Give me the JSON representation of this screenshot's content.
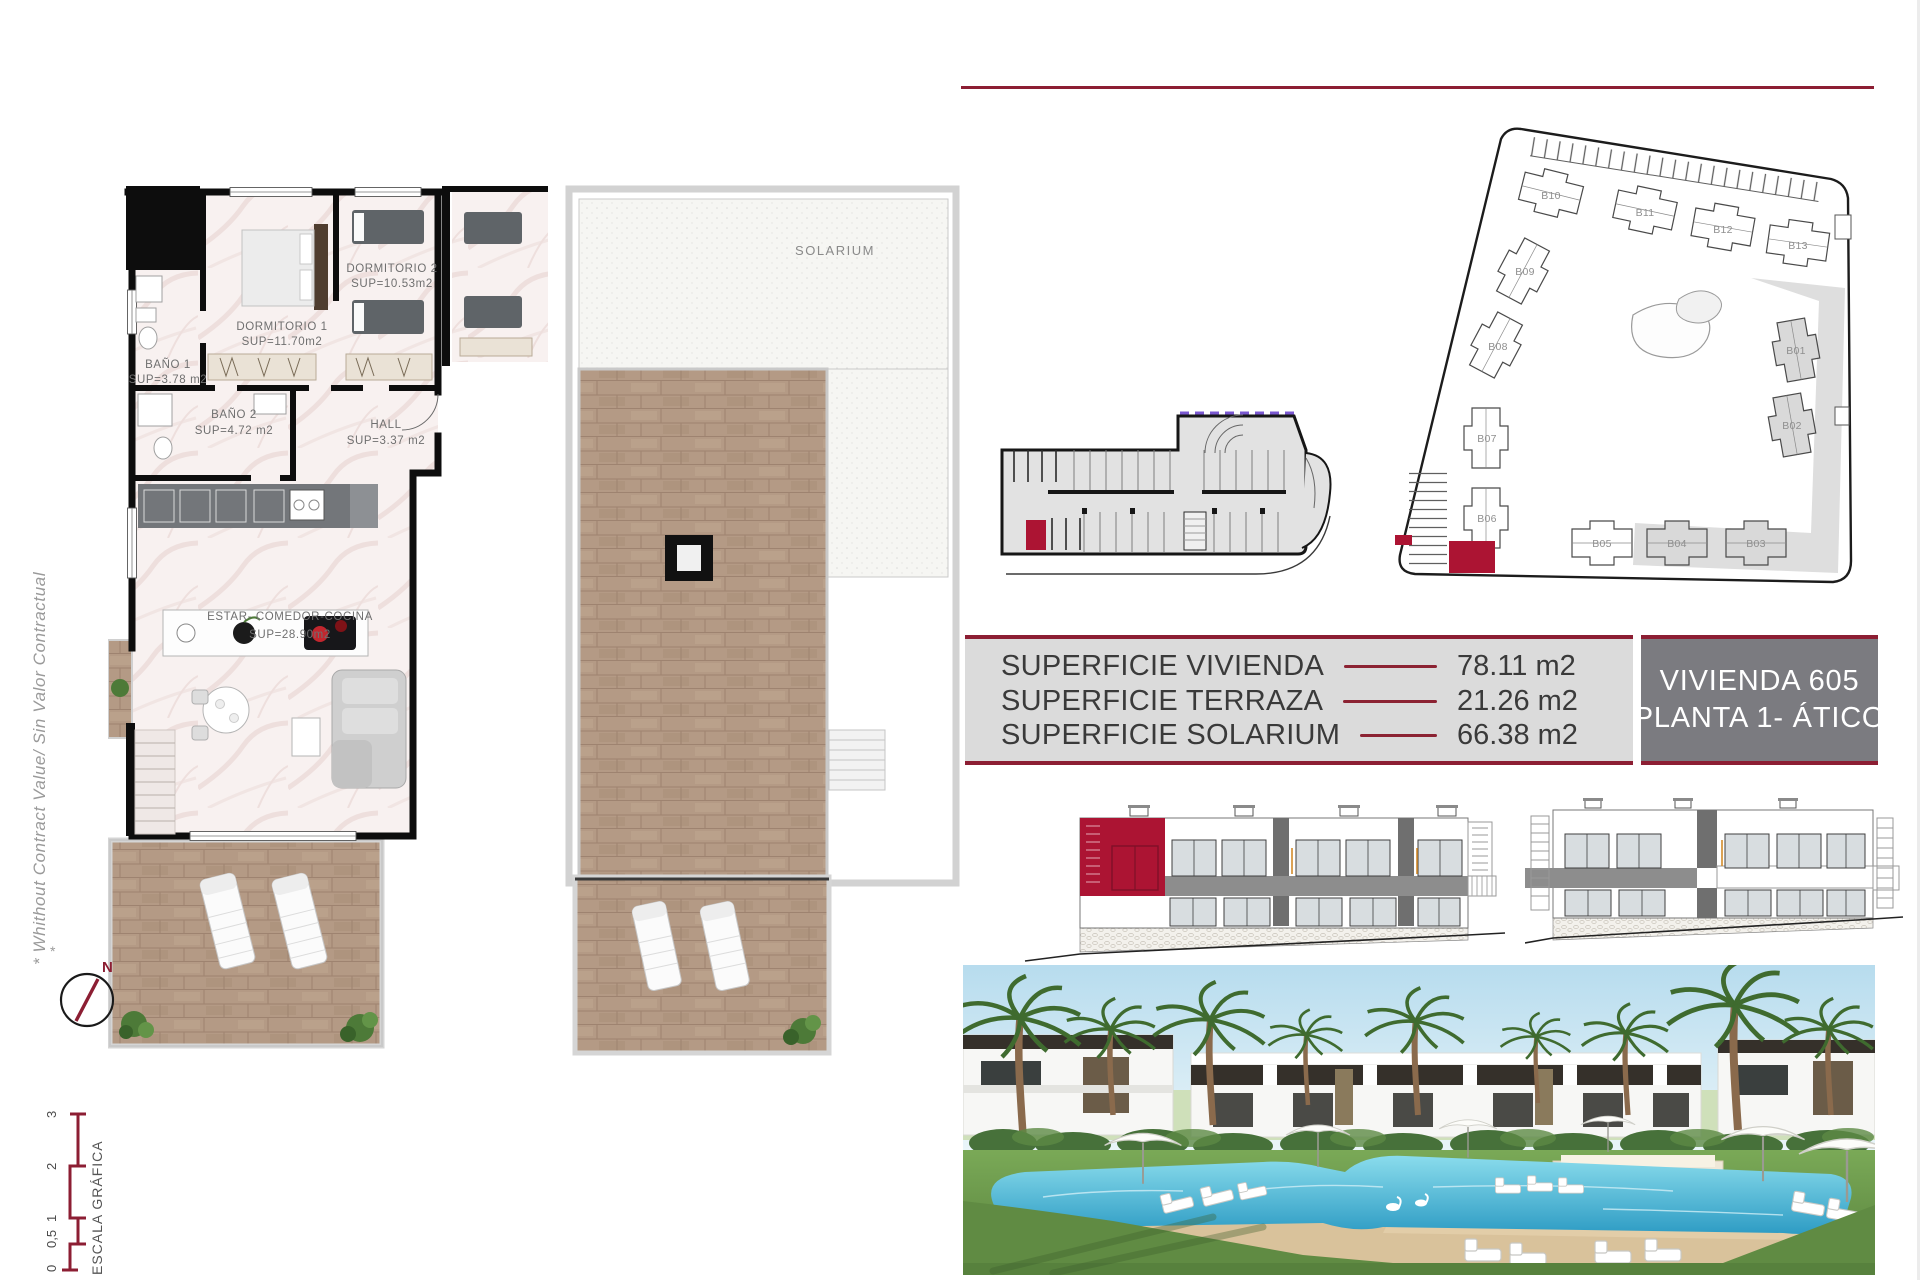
{
  "sheet": {
    "disclaimer": "* Whithout Contract Value/ Sin Valor Contractual",
    "north_label": "N",
    "footnote_star": "*",
    "scale": {
      "label": "ESCALA GRÁFICA",
      "ticks": [
        "0",
        "0,5",
        "1",
        "2",
        "3"
      ]
    }
  },
  "apartment_plan": {
    "rooms": [
      {
        "name": "DORMITORIO 1",
        "sup": "SUP=11.70m2"
      },
      {
        "name": "DORMITORIO 2",
        "sup": "SUP=10.53m2"
      },
      {
        "name": "BAÑO 1",
        "sup": "SUP=3.78 m2"
      },
      {
        "name": "BAÑO 2",
        "sup": "SUP=4.72 m2"
      },
      {
        "name": "HALL",
        "sup": "SUP=3.37 m2"
      },
      {
        "name": "ESTAR- COMEDOR-COCINA",
        "sup": "SUP=28.90m2"
      }
    ]
  },
  "solarium_plan": {
    "label": "SOLARIUM"
  },
  "location_plans": {
    "blocks": [
      "B01",
      "B02",
      "B03",
      "B04",
      "B05",
      "B06",
      "B07",
      "B08",
      "B09",
      "B10",
      "B11",
      "B12",
      "B13"
    ]
  },
  "summary_table": {
    "rows": [
      {
        "label": "SUPERFICIE VIVIENDA",
        "value": "78.11 m2"
      },
      {
        "label": "SUPERFICIE TERRAZA",
        "value": "21.26 m2"
      },
      {
        "label": "SUPERFICIE SOLARIUM",
        "value": "66.38 m2"
      }
    ]
  },
  "unit_badge": {
    "line1": "VIVIENDA 605",
    "line2": "PLANTA 1- ÁTICO"
  },
  "colors": {
    "accent_maroon": "#8c1e33",
    "highlight_red": "#ac1433",
    "table_bg": "#dbdbdb",
    "badge_bg": "#7b7b80",
    "wood": "#b49a85",
    "purple_dash": "#7a58d0",
    "pool_blue": "#59c2dd"
  }
}
